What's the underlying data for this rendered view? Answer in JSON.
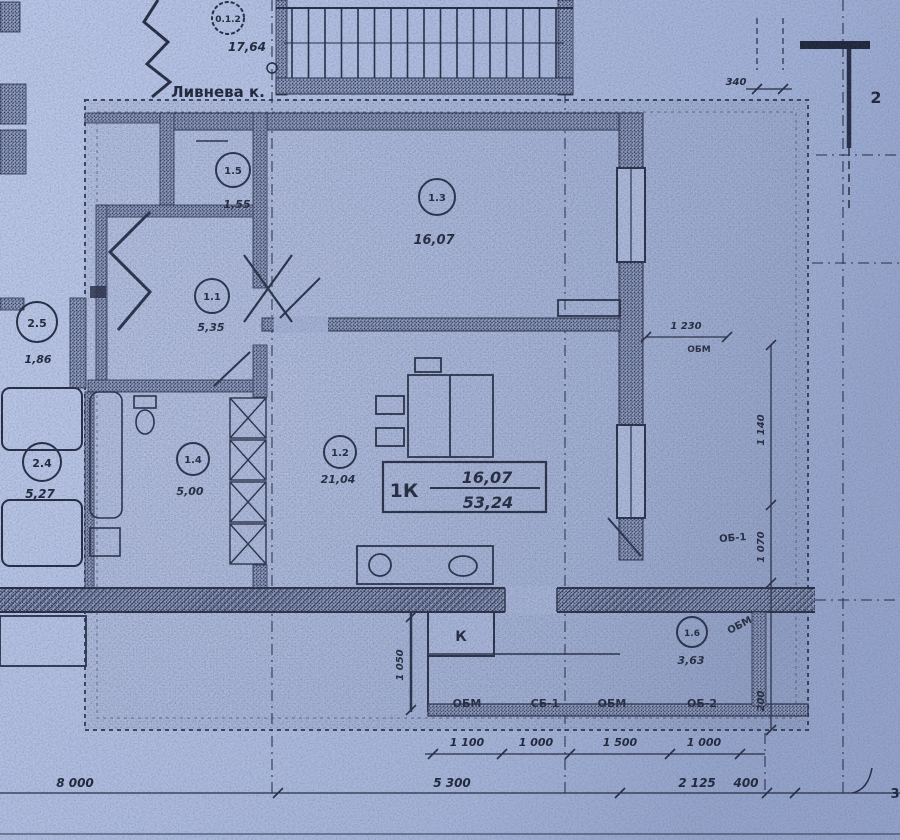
{
  "top_tag": {
    "tag": "0.1.2",
    "area": "17,64"
  },
  "labels": {
    "street": "Ливнева к.",
    "k_duct": "К",
    "ob1": "ОБ-1",
    "obm_diagonal": "ОБМ",
    "obm_opening": "ОБМ",
    "balcony_row": [
      "ОБМ",
      "СБ-1",
      "ОБМ",
      "ОБ-2"
    ],
    "axis_2": "2",
    "axis_3": "3"
  },
  "summary": {
    "apt_label": "1К",
    "living": "16,07",
    "total": "53,24"
  },
  "rooms": [
    {
      "tag": "1.5",
      "area": "1,55"
    },
    {
      "tag": "1.3",
      "area": "16,07"
    },
    {
      "tag": "1.1",
      "area": "5,35"
    },
    {
      "tag": "1.4",
      "area": "5,00"
    },
    {
      "tag": "1.2",
      "area": "21,04"
    },
    {
      "tag": "1.6",
      "area": "3,63"
    }
  ],
  "neighbors": [
    {
      "tag": "2.5",
      "area": "1,86"
    },
    {
      "tag": "2.4",
      "area": "5,27"
    }
  ],
  "dims": {
    "top": "340",
    "opening_width": "1 230",
    "balcony_chain": [
      "1 100",
      "1 000",
      "1 500",
      "1 000"
    ],
    "bottom_chain": [
      "8 000",
      "5 300",
      "2 125",
      "400"
    ],
    "right_chain": [
      "1 140",
      "1 070",
      "200"
    ],
    "k_height": "1 050"
  },
  "colors": {
    "paper": "#a9b7dd",
    "ink": "#1d2438"
  }
}
